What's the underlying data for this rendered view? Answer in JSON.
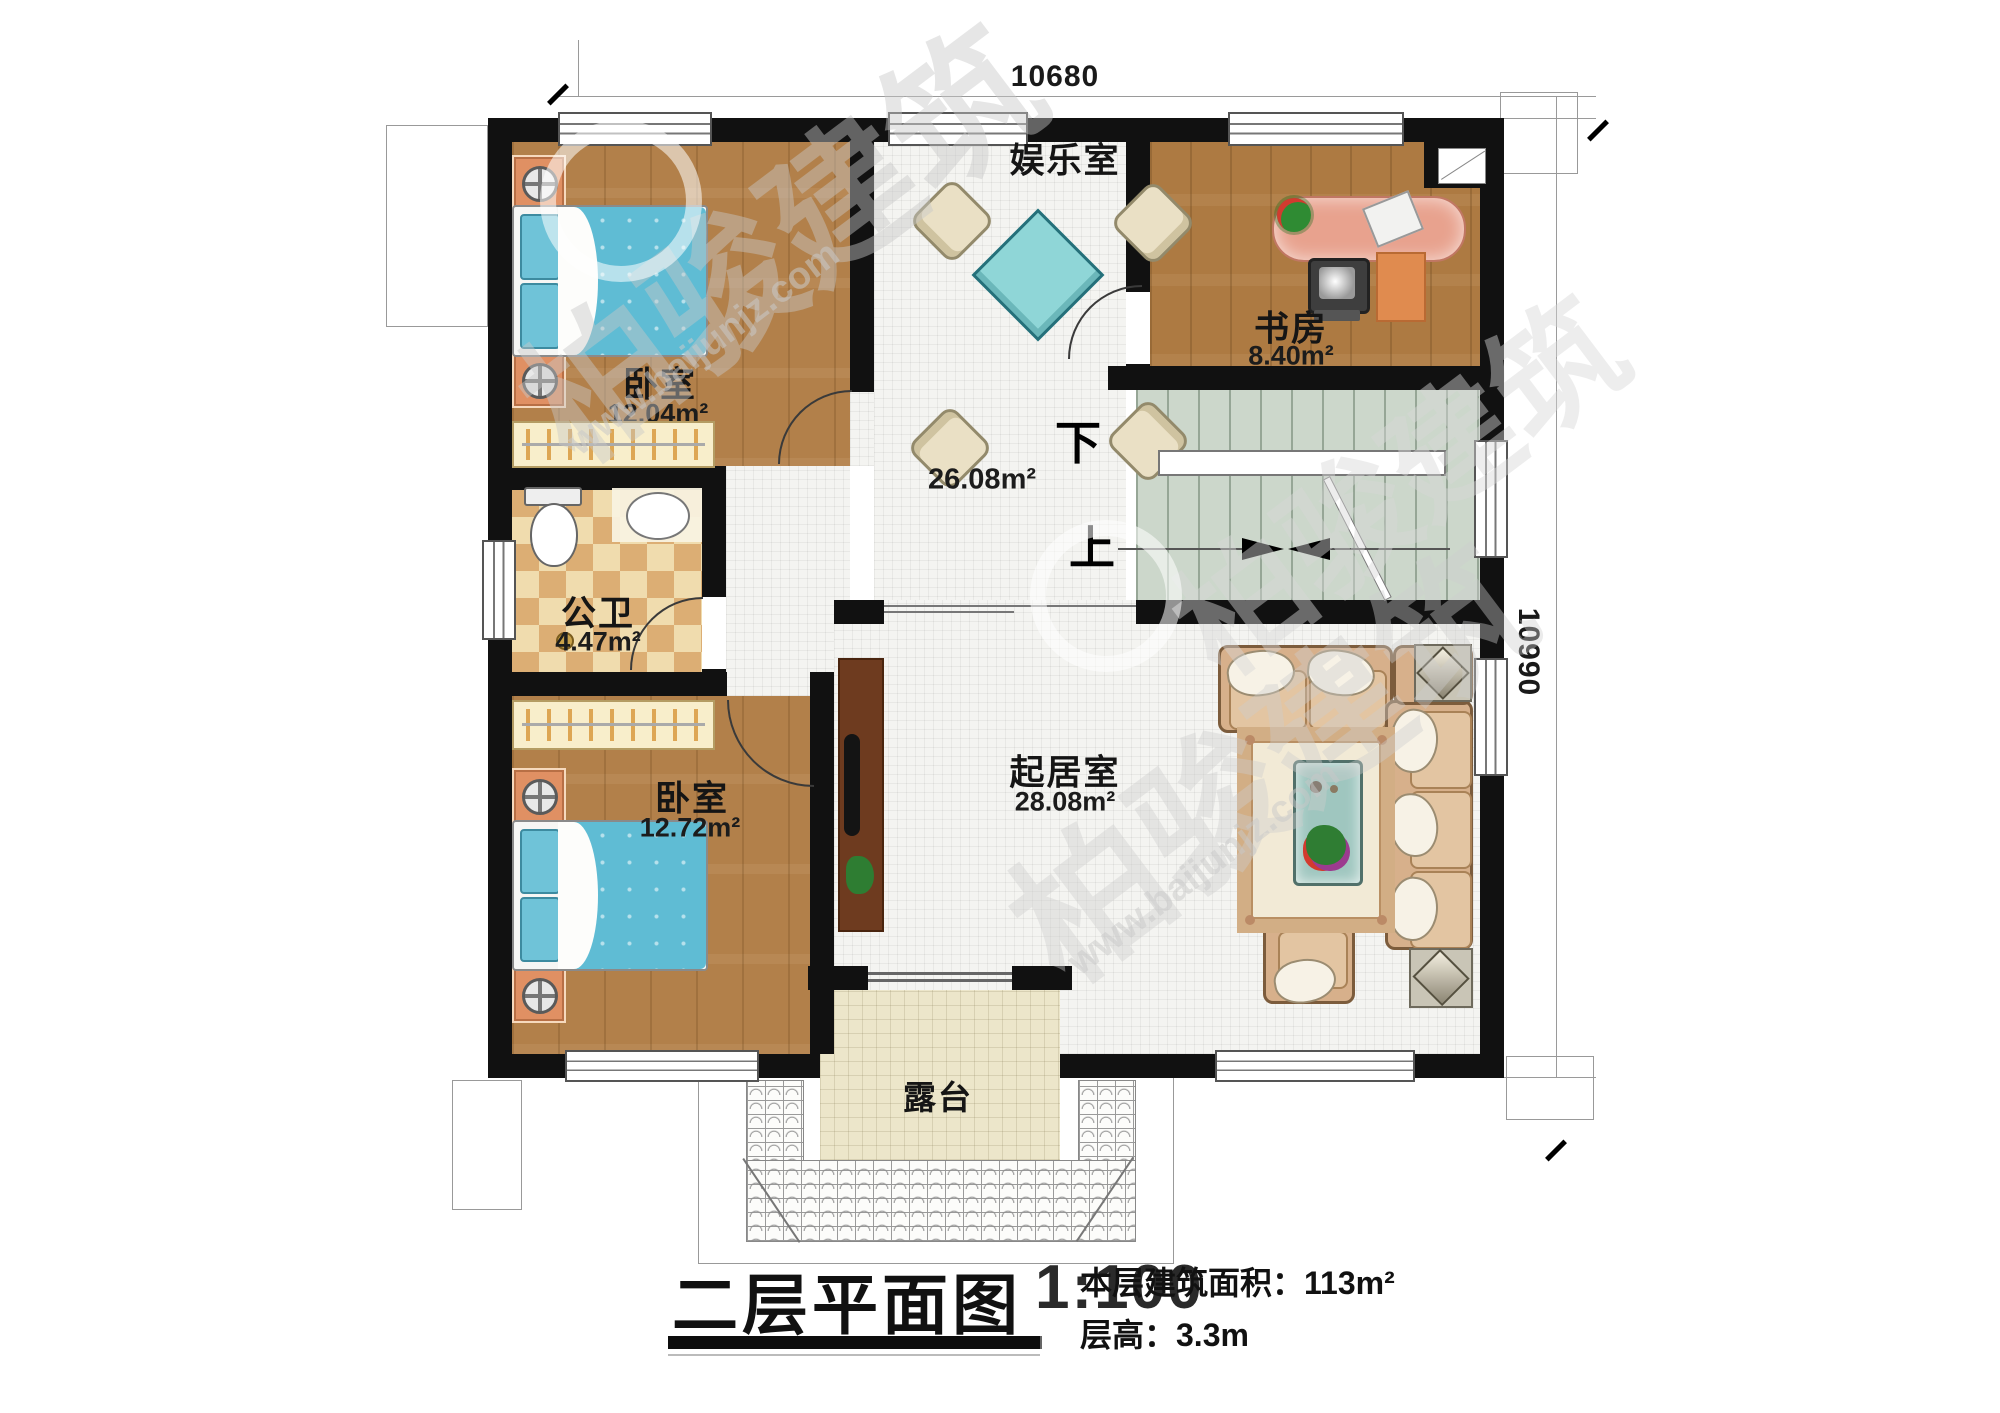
{
  "watermark": {
    "brand": "柏骏建筑",
    "url": "www.baijunjz.com"
  },
  "dimensions": {
    "top": "10680",
    "right": "10990"
  },
  "rooms": {
    "bedroom_top": {
      "name": "卧室",
      "area": "12.04m²"
    },
    "bathroom": {
      "name": "公卫",
      "area": "4.47m²"
    },
    "bedroom_bottom": {
      "name": "卧室",
      "area": "12.72m²"
    },
    "entertainment": {
      "name": "娱乐室"
    },
    "hall": {
      "area": "26.08m²"
    },
    "study": {
      "name": "书房",
      "area": "8.40m²"
    },
    "living": {
      "name": "起居室",
      "area": "28.08m²"
    },
    "terrace": {
      "name": "露台"
    }
  },
  "stairs": {
    "down": "下",
    "up": "上"
  },
  "titleblock": {
    "title": "二层平面图",
    "scale": "1:100",
    "area_line": "本层建筑面积：113m²",
    "height_line": "层高：3.3m"
  }
}
